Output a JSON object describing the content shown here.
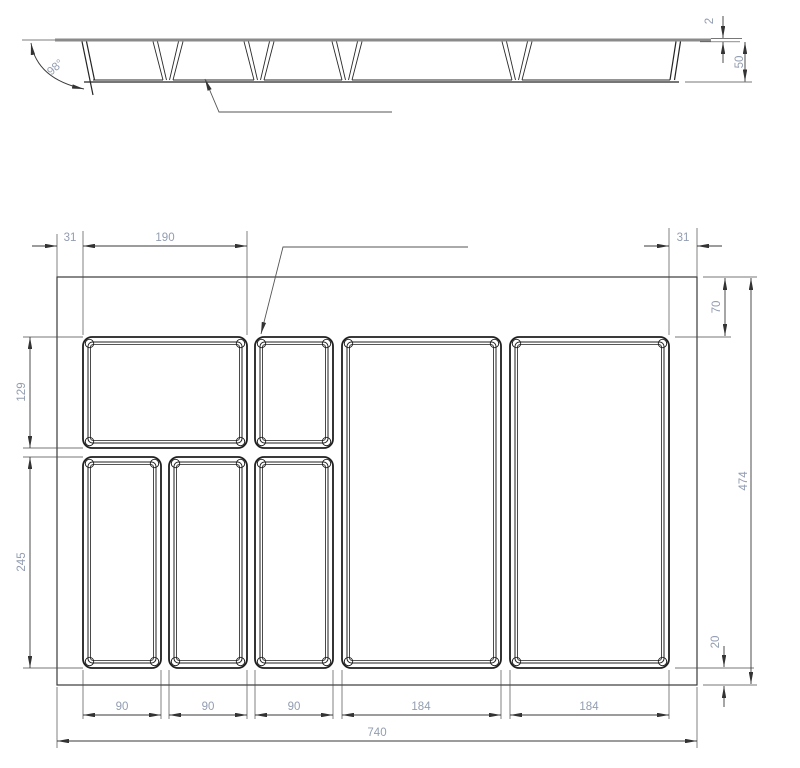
{
  "side_view": {
    "angle_label": "98°",
    "top_thickness": "2",
    "tray_height": "50"
  },
  "plan_view": {
    "left_margin": "31",
    "top_left_compartment_width": "190",
    "right_margin": "31",
    "upper_left_compartment_depth": "129",
    "lower_compartment_depth": "245",
    "top_offset": "70",
    "overall_depth": "474",
    "bottom_offset": "20",
    "bottom_widths": [
      "90",
      "90",
      "90",
      "184",
      "184"
    ],
    "overall_width": "740"
  },
  "colors": {
    "background": "#ffffff",
    "geometry_line": "#1f1f1f",
    "dimension_line": "#3a3a3a",
    "rim_line": "#8a8a8a",
    "dimension_text": "#929db1"
  }
}
